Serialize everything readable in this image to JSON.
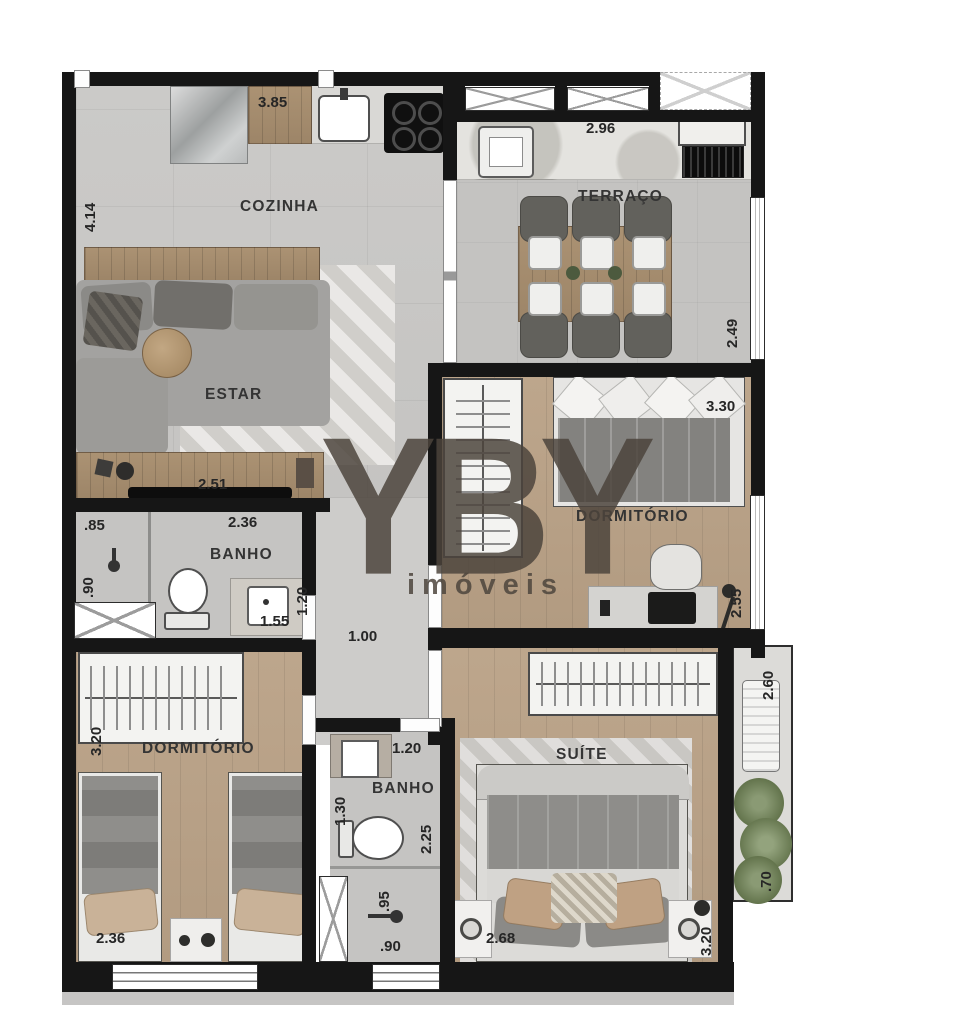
{
  "watermark": {
    "logo": "YBY",
    "subtitle": "imóveis"
  },
  "rooms": {
    "cozinha": {
      "label": "COZINHA",
      "width": "3.85",
      "depth": "4.14"
    },
    "estar": {
      "label": "ESTAR",
      "console_width": "2.51"
    },
    "terraco": {
      "label": "TERRAÇO",
      "width": "2.96",
      "depth": "2.49"
    },
    "dormitorio1": {
      "label": "DORMITÓRIO",
      "width": "3.30",
      "depth": "2.55"
    },
    "banho1": {
      "label": "BANHO",
      "width": "2.36",
      "shower_width": ".85",
      "shower_depth": ".90",
      "depth": "1.20",
      "vanity_width": "1.55"
    },
    "hall": {
      "width": "1.00"
    },
    "dormitorio2": {
      "label": "DORMITÓRIO",
      "depth": "3.20",
      "bed_width": "2.36"
    },
    "banho2": {
      "label": "BANHO",
      "width": "1.20",
      "vanity_depth": "1.30",
      "depth": "2.25",
      "shower_depth": ".95",
      "shower_width": ".90"
    },
    "suite": {
      "label": "SUÍTE",
      "width": "2.68",
      "depth": "3.20"
    },
    "planter": {
      "depth": "2.60",
      "width": ".70"
    }
  }
}
